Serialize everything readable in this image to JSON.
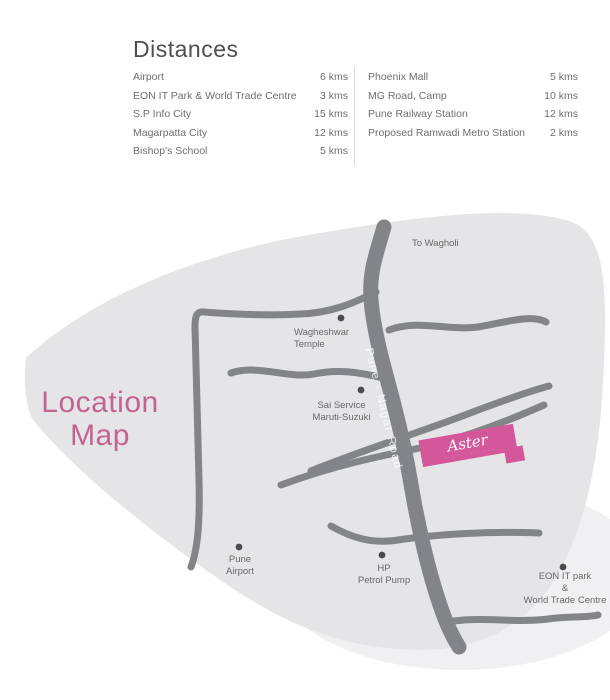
{
  "distances": {
    "title": "Distances",
    "left_column": [
      {
        "name": "Airport",
        "distance": "6 kms"
      },
      {
        "name": "EON IT Park & World Trade Centre",
        "distance": "3 kms"
      },
      {
        "name": "S.P Info City",
        "distance": "15 kms"
      },
      {
        "name": "Magarpatta City",
        "distance": "12 kms"
      },
      {
        "name": "Bishop's School",
        "distance": "5 kms"
      }
    ],
    "right_column": [
      {
        "name": "Phoenix Mall",
        "distance": "5 kms"
      },
      {
        "name": "MG Road, Camp",
        "distance": "10 kms"
      },
      {
        "name": "Pune Railway Station",
        "distance": "12 kms"
      },
      {
        "name": "Proposed Ramwadi Metro Station",
        "distance": "2 kms"
      }
    ]
  },
  "map": {
    "title": "Location\nMap",
    "road_label": "Pune - Nagar Road",
    "labels": {
      "to_wagholi": "To Wagholi",
      "wagheshwar_temple": "Wagheshwar\nTemple",
      "sai_service": "Sai Service\nMaruti-Suzuki",
      "pune_airport": "Pune\nAirport",
      "hp_petrol_pump": "HP\nPetrol Pump",
      "eon_it_park": "EON IT park\n&\nWorld Trade Centre"
    },
    "aster_marker": {
      "name": "Aster",
      "tagline": "· · · · · · · · · · · ·"
    },
    "colors": {
      "title_pink": "#c2648f",
      "aster_pink": "#d4579a",
      "road_gray": "#828487",
      "map_background_gray": "#e5e5e7",
      "text_gray": "#6d6e70"
    }
  }
}
